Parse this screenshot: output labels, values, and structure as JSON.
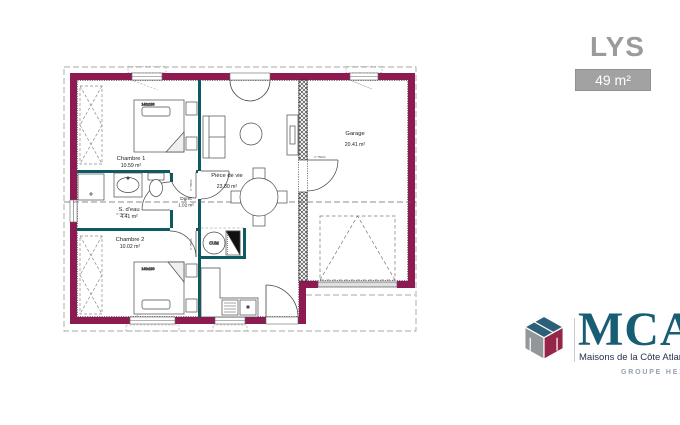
{
  "header": {
    "title": "LYS",
    "area_badge": "49 m²"
  },
  "plan": {
    "rooms": [
      {
        "name": "Chambre 1",
        "area": "10.59 m²"
      },
      {
        "name": "S. d'eau",
        "area": "4.41 m²"
      },
      {
        "name": "Chambre 2",
        "area": "10.02 m²"
      },
      {
        "name": "Dgmt",
        "area": "1.02 m²"
      },
      {
        "name": "Pièce de vie",
        "area": "23.80 m²"
      },
      {
        "name": "Garage",
        "area": "20.41 m²"
      }
    ],
    "labels": {
      "bed_size": "140x190",
      "water_heater": "CUM",
      "door_code": "P 75004"
    },
    "colors": {
      "exterior_wall": "#8e1a52",
      "partition_wall": "#0d5a63",
      "title_gray": "#9b9b9b"
    }
  },
  "branding": {
    "logo_acronym": "MCA",
    "logo_name": "Maisons de la Côte Atlantique",
    "logo_group": "GROUPE HEXAOM"
  }
}
